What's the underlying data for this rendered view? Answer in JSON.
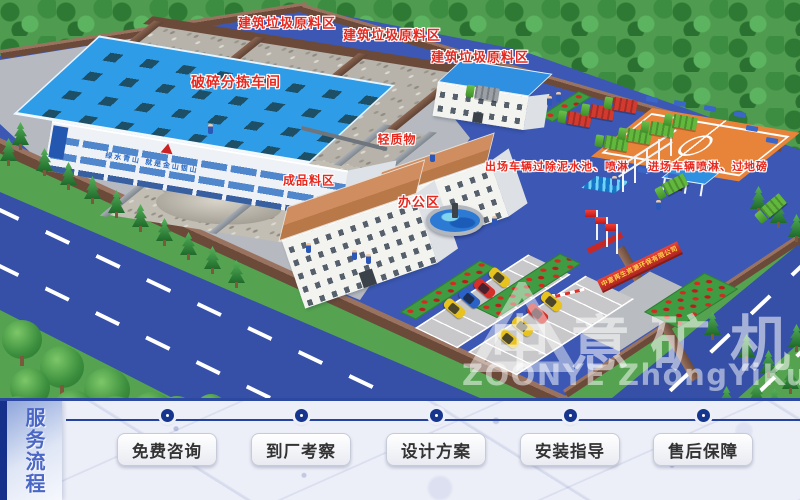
{
  "scene": {
    "labels": {
      "raw_zone_1": "建筑垃圾原料区",
      "raw_zone_2": "建筑垃圾原料区",
      "raw_zone_3": "建筑垃圾原料区",
      "crushing_workshop": "破碎分拣车间",
      "light_material": "轻质物",
      "finished_product_zone": "成品料区",
      "office_area": "办公区",
      "exit_wash": "出场车辆过除泥水池、喷淋",
      "entry_wash": "进场车辆喷淋、过地磅"
    },
    "factory_slogan": "绿水青山 就是金山银山",
    "gate_sign": "中意再生资源环保有限公司",
    "watermark": {
      "cn": "中意矿机",
      "en": "ZOONYE ZhongYiKuangJi"
    }
  },
  "service_bar": {
    "title": "服务流程",
    "steps": [
      {
        "label": "免费咨询"
      },
      {
        "label": "到厂考察"
      },
      {
        "label": "设计方案"
      },
      {
        "label": "安装指导"
      },
      {
        "label": "售后保障"
      }
    ]
  },
  "colors": {
    "accent_navy": "#16368e",
    "label_red": "#e8281e",
    "ground_blue": "#3c58b4",
    "road_blue": "#3550a6",
    "roof_blue": "#2f9ce8",
    "roof_tan": "#c8835a",
    "wall_brown": "#6b4a3a",
    "lawn_green": "#3f9c42"
  }
}
